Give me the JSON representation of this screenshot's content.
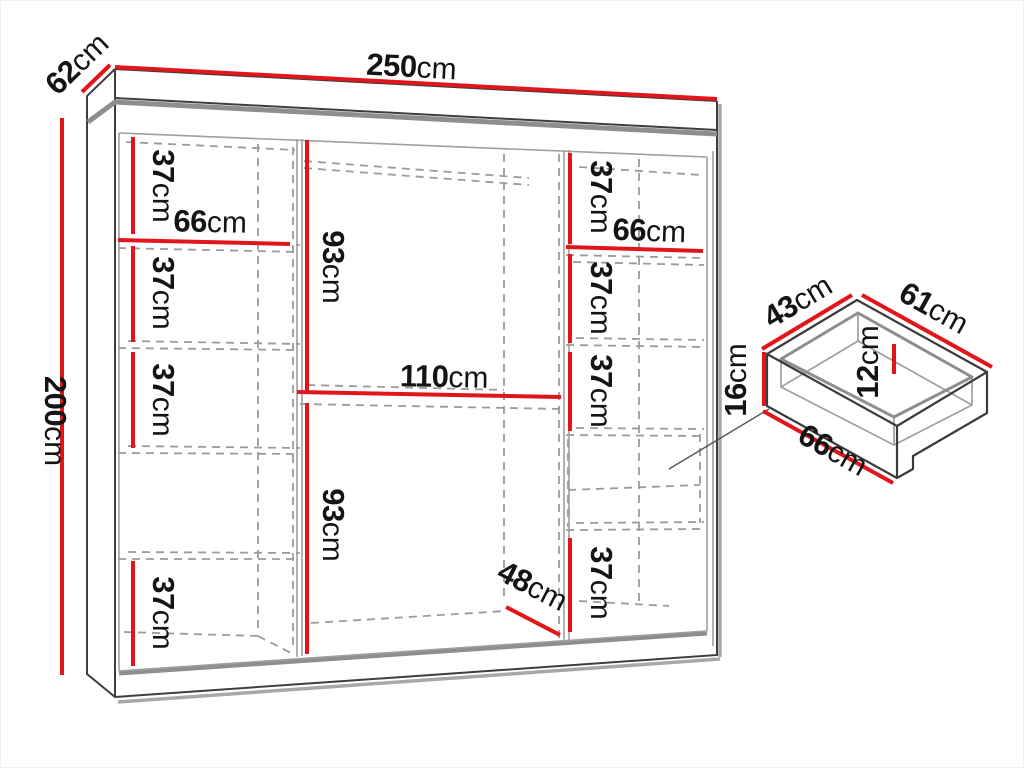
{
  "colors": {
    "dimension_red": "#e2151b",
    "text_dark": "#141414",
    "line_dark": "#3e3e3e",
    "line_soft": "#8e8e8e",
    "line_light": "#9f9f9f",
    "line_dash": "#9b9b9b",
    "line_shadow": "#a8a8a8"
  },
  "wardrobe": {
    "width": {
      "num": "250",
      "unit": "cm"
    },
    "depth": {
      "num": "62",
      "unit": "cm"
    },
    "height": {
      "num": "200",
      "unit": "cm"
    },
    "left_column": {
      "width": {
        "num": "66",
        "unit": "cm"
      },
      "gap_1": {
        "num": "37",
        "unit": "cm"
      },
      "gap_2": {
        "num": "37",
        "unit": "cm"
      },
      "gap_3": {
        "num": "37",
        "unit": "cm"
      },
      "gap_4": {
        "num": "37",
        "unit": "cm"
      }
    },
    "middle_column": {
      "upper_height": {
        "num": "93",
        "unit": "cm"
      },
      "shelf_width": {
        "num": "110",
        "unit": "cm"
      },
      "lower_height": {
        "num": "93",
        "unit": "cm"
      },
      "floor_depth": {
        "num": "48",
        "unit": "cm"
      }
    },
    "right_column": {
      "width": {
        "num": "66",
        "unit": "cm"
      },
      "gap_1": {
        "num": "37",
        "unit": "cm"
      },
      "gap_2": {
        "num": "37",
        "unit": "cm"
      },
      "gap_3": {
        "num": "37",
        "unit": "cm"
      },
      "gap_4": {
        "num": "37",
        "unit": "cm"
      }
    }
  },
  "drawer": {
    "depth": {
      "num": "43",
      "unit": "cm"
    },
    "width": {
      "num": "61",
      "unit": "cm"
    },
    "front_height": {
      "num": "16",
      "unit": "cm"
    },
    "inner_height": {
      "num": "12",
      "unit": "cm"
    },
    "front_width": {
      "num": "66",
      "unit": "cm"
    }
  }
}
